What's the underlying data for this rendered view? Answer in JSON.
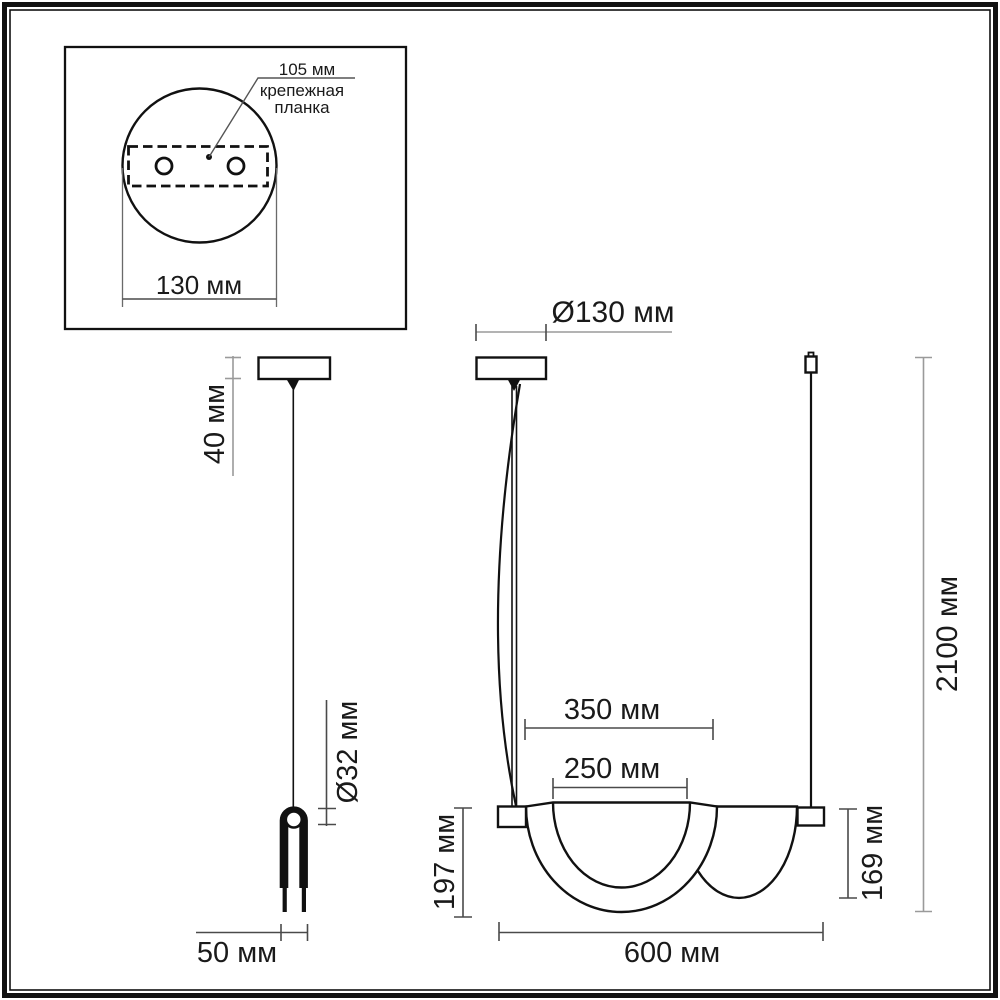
{
  "drawing": {
    "type": "pendant-lamp-dimension-drawing",
    "units": "мм"
  },
  "inset": {
    "hole_spacing_label": "105 мм",
    "plate_label_line1": "крепежная",
    "plate_label_line2": "планка",
    "canopy_width_label": "130 мм"
  },
  "side_view": {
    "canopy_height_label": "40 мм",
    "tube_diameter_label": "Ø32 мм",
    "fork_width_label": "50 мм"
  },
  "front_view": {
    "canopy_diameter_label": "Ø130 мм",
    "outer_shade_width_label": "350 мм",
    "inner_shade_width_label": "250 мм",
    "front_shade_height_label": "197 мм",
    "rear_shade_height_label": "169 мм",
    "fixture_width_label": "600 мм",
    "suspension_height_label": "2100 мм"
  },
  "colors": {
    "object_line": "#111111",
    "dimension_line": "#4a4a4a",
    "dimension_line_light": "#9a9a9a",
    "background": "#ffffff"
  }
}
